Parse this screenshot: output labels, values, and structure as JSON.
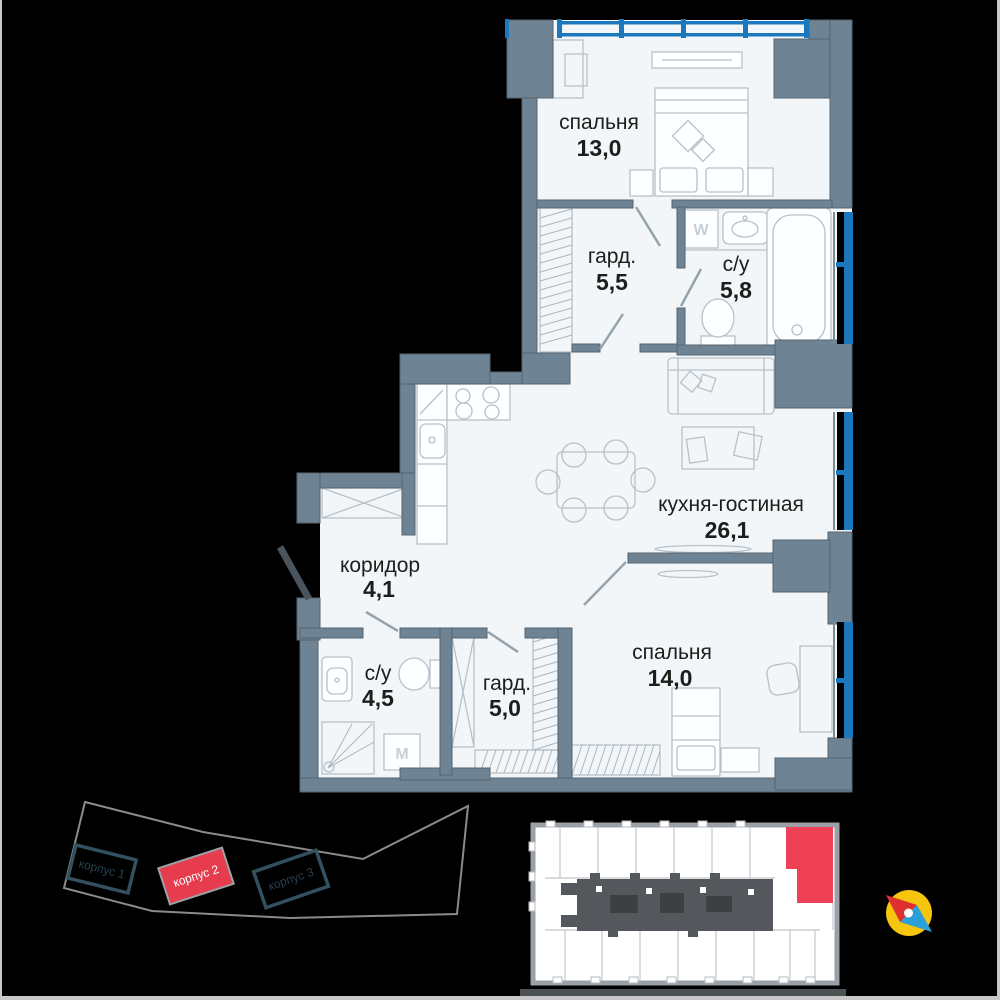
{
  "plan": {
    "rooms": [
      {
        "id": "bedroom-1",
        "name": "спальня",
        "area": "13,0"
      },
      {
        "id": "wardrobe-1",
        "name": "гард.",
        "area": "5,5"
      },
      {
        "id": "bathroom-1",
        "name": "с/у",
        "area": "5,8"
      },
      {
        "id": "kitchen-living",
        "name": "кухня-гостиная",
        "area": "26,1"
      },
      {
        "id": "corridor",
        "name": "коридор",
        "area": "4,1"
      },
      {
        "id": "bathroom-2",
        "name": "с/у",
        "area": "4,5"
      },
      {
        "id": "wardrobe-2",
        "name": "гард.",
        "area": "5,0"
      },
      {
        "id": "bedroom-2",
        "name": "спальня",
        "area": "14,0"
      }
    ],
    "appliances": {
      "washer_top": "W",
      "washer_bottom": "M"
    }
  },
  "site_plan": {
    "buildings": [
      {
        "label": "корпус 1",
        "highlighted": false
      },
      {
        "label": "корпус 2",
        "highlighted": true
      },
      {
        "label": "корпус 3",
        "highlighted": false
      }
    ]
  },
  "colors": {
    "wall": "#6e8394",
    "room_fill": "#f2f6f9",
    "window_blue": "#1b78bc",
    "highlight_red": "#e73c4e",
    "keyplan_red": "#ee4155",
    "compass_yellow": "#f6c50e",
    "background": "#000000"
  }
}
